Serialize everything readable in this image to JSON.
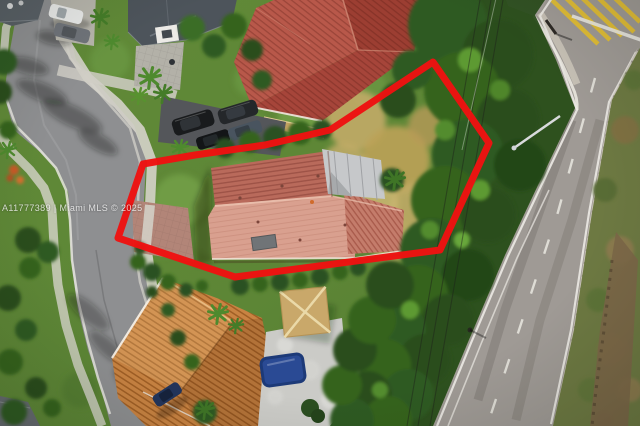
{
  "watermark": {
    "text": "A11777389 | Miami MLS © 2025"
  },
  "annotation": {
    "boundary_color": "#ee1211",
    "boundary_points": "433,62 489,143 440,250 235,277 118,238 143,164 195,155 265,145 330,130"
  },
  "palette": {
    "grass": "#5d8636",
    "dry_grass": "#c2ab67",
    "street_asphalt": "#8e8f91",
    "highway_asphalt": "#9a948f",
    "sidewalk_concrete": "#d5d3ca",
    "subject_roof_tile": "#b96a5b",
    "subject_roof_tile_light": "#d9a08f",
    "subject_metal_roof": "#c6c8ca",
    "neighbor_roof_red": "#ae4f42",
    "neighbor_roof_orange": "#c98342",
    "gazebo_roof": "#c9a86a",
    "pool_cover_blue": "#2a4a94",
    "lane_paint_yellow": "#e0bd37",
    "lane_paint_white": "#eceae4",
    "tree_canopy": "#2f5a22",
    "boundary_red": "#ee1211"
  }
}
